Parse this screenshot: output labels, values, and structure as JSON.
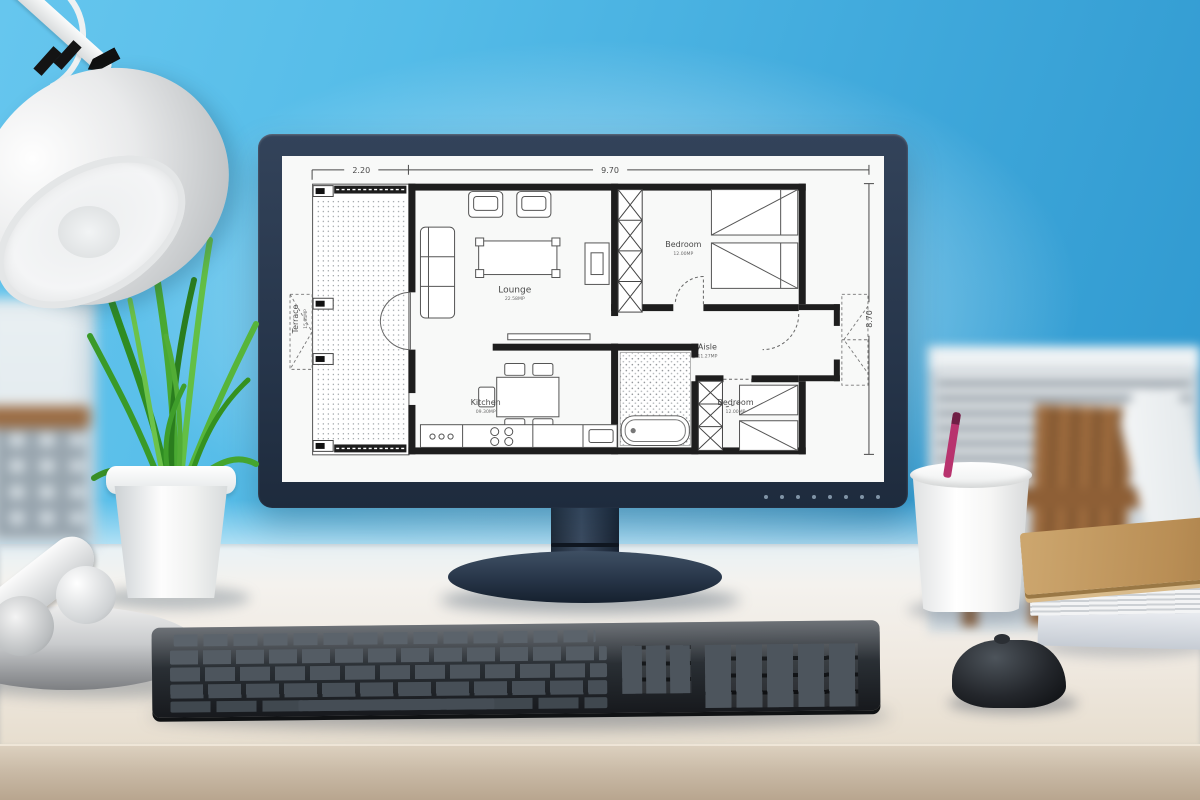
{
  "floor_plan": {
    "dim_top_left": "2.20",
    "dim_top_right": "9.70",
    "dim_right": "8.70",
    "rooms": {
      "terrace": {
        "name": "Terrace",
        "area": "15.64MP"
      },
      "lounge": {
        "name": "Lounge",
        "area": "22.58MP"
      },
      "bedroom_top": {
        "name": "Bedroom",
        "area": "12.00MP"
      },
      "aisle": {
        "name": "Aisle",
        "area": "11.27MP"
      },
      "kitchen": {
        "name": "Kitchen",
        "area": "09.30MP"
      },
      "bedroom_bottom": {
        "name": "Bedroom",
        "area": "12.00MP"
      }
    }
  },
  "colors": {
    "wall_blue": "#45b1e2",
    "monitor_bezel": "#2b3a4e",
    "plan_line": "#3a3a3a",
    "desk_surface": "#efeae3",
    "plant_green": "#4aa32d",
    "folder_kraft": "#c39a63",
    "pen_pink": "#b8336e"
  }
}
